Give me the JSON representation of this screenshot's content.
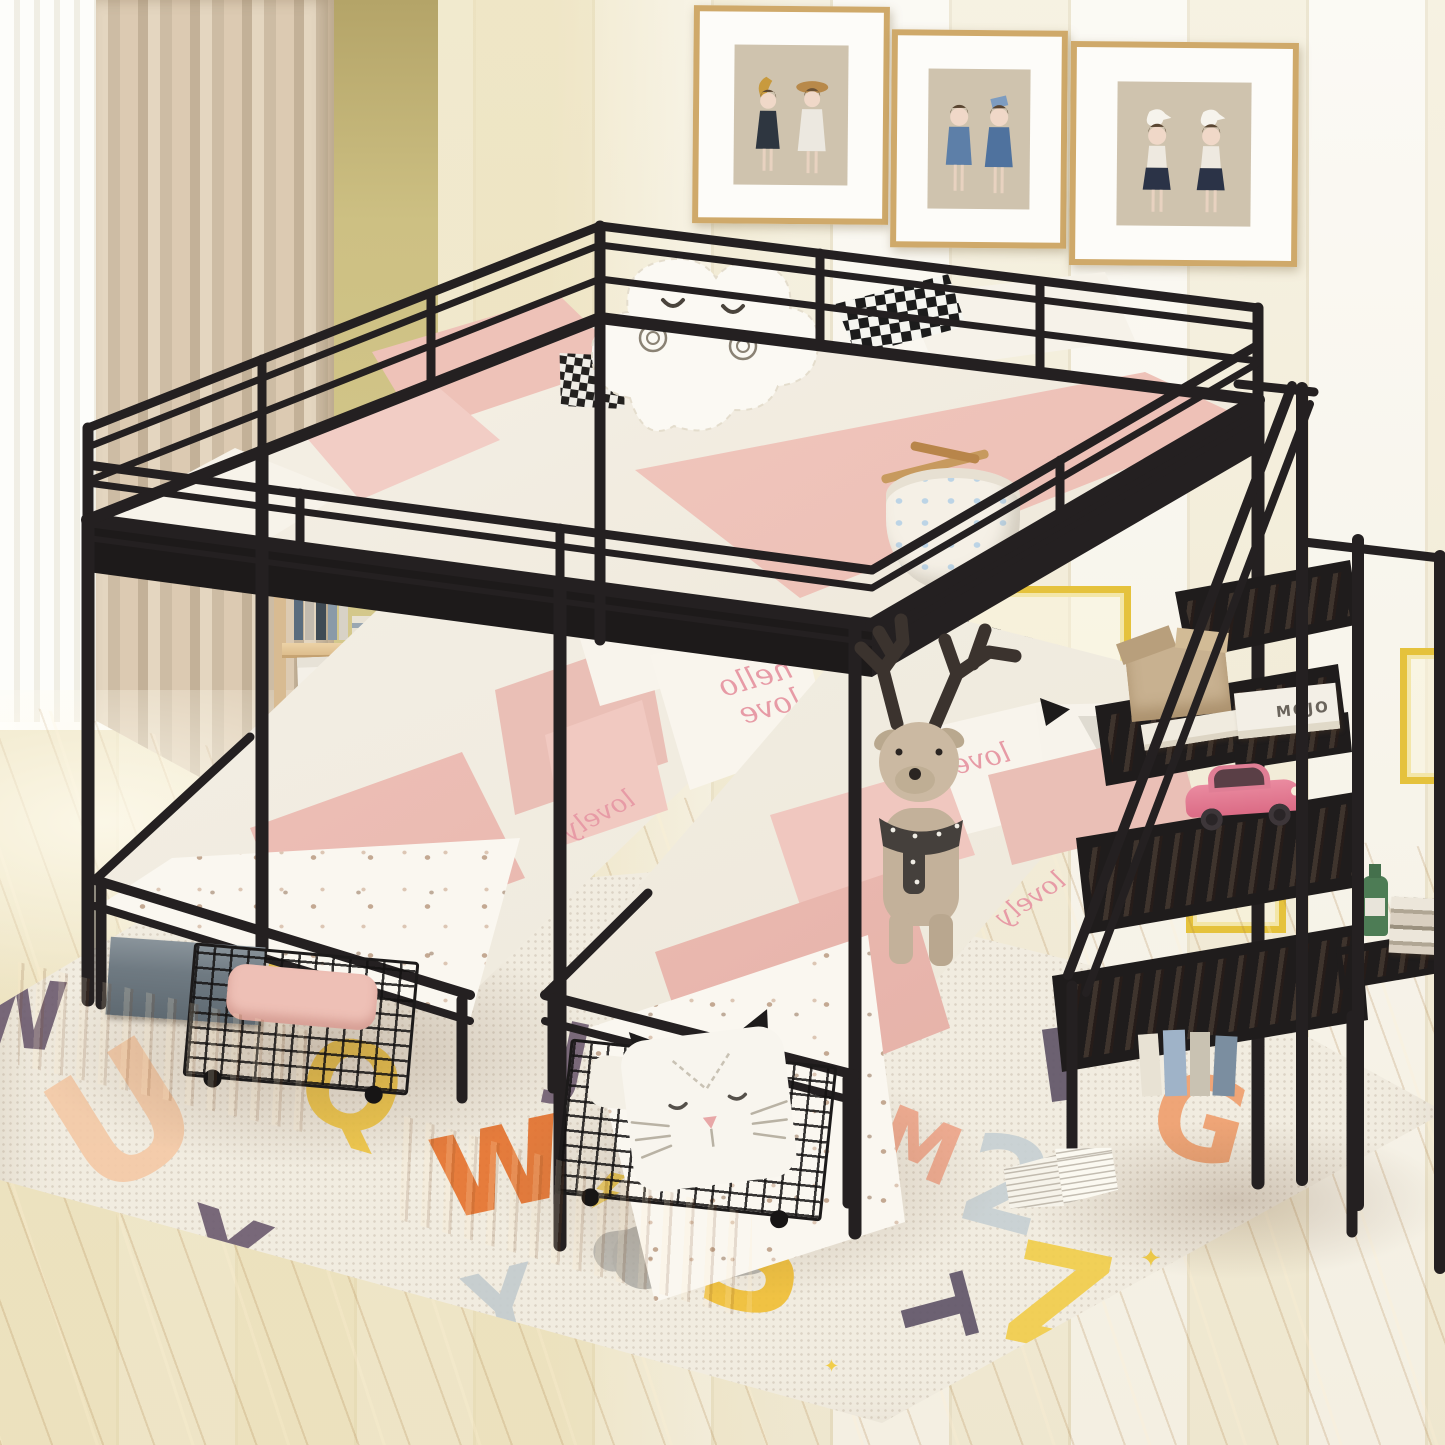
{
  "scene": {
    "description": "Kids bedroom product photo: black metal full-over-twin-twin triple bunk bed with storage staircase, pink and white bedding, alphabet rug, wall art prints",
    "wall_art": {
      "frames": [
        {
          "name": "print-girls-with-moon-and-hat"
        },
        {
          "name": "print-girls-in-blue-with-book"
        },
        {
          "name": "print-girls-with-geese"
        }
      ]
    },
    "counts": {
      "picture_frames": 3,
      "stair_steps": 4,
      "under_bed_drawers": 2,
      "twin_beds": 2
    }
  },
  "palette": {
    "metal_frame": "#242021",
    "wall_cream": "#f3edd8",
    "wall_white": "#faf8f1",
    "wall_olive": "#cdc083",
    "curtain_beige": "#d9c9b1",
    "floor_wood": "#e2c69c",
    "rug_cream": "#f1ece0",
    "bedding_pink": "#efc5bc",
    "bedding_white": "#f6f2e9",
    "step_wood": "#984b28",
    "drawer_wood": "#c08049",
    "shelf_wood": "#e5c99e",
    "gold_molding": "#e5c23c",
    "toy_car_pink": "#e0728a"
  },
  "texts": {
    "pillow_script_1": "hello love",
    "pillow_script_2": "love",
    "duvet_script": "lovely",
    "book_spine": "MOJO"
  },
  "rug": {
    "letters": [
      {
        "char": "U",
        "color": "#f4c9a6",
        "x": 55,
        "y": 1035,
        "size": 170,
        "rot": -32
      },
      {
        "char": "Q",
        "color": "#f1c741",
        "x": 300,
        "y": 1028,
        "size": 120,
        "rot": 16
      },
      {
        "char": "B",
        "color": "#f1c741",
        "x": 262,
        "y": 922,
        "size": 82,
        "rot": 10
      },
      {
        "char": "J",
        "color": "#6f5d72",
        "x": 556,
        "y": 1012,
        "size": 92,
        "rot": 12
      },
      {
        "char": "w",
        "color": "#e5702b",
        "x": 428,
        "y": 1082,
        "size": 150,
        "rot": -12
      },
      {
        "char": "X",
        "color": "#6b5a6e",
        "x": 178,
        "y": 1200,
        "size": 115,
        "rot": 18
      },
      {
        "char": "Y",
        "color": "#c3cbce",
        "x": 468,
        "y": 1258,
        "size": 96,
        "rot": -14
      },
      {
        "char": "S",
        "color": "#f0be33",
        "x": 698,
        "y": 1182,
        "size": 152,
        "rot": 8
      },
      {
        "char": "Z",
        "color": "#f1cd49",
        "x": 1008,
        "y": 1232,
        "size": 140,
        "rot": 12
      },
      {
        "char": "T",
        "color": "#5e5366",
        "x": 903,
        "y": 1262,
        "size": 96,
        "rot": 75
      },
      {
        "char": "2",
        "color": "#c6d0d3",
        "x": 962,
        "y": 1122,
        "size": 126,
        "rot": 15
      },
      {
        "char": "M",
        "color": "#efa68a",
        "x": 878,
        "y": 1106,
        "size": 82,
        "rot": 22
      },
      {
        "char": "G",
        "color": "#ef9e6c",
        "x": 1152,
        "y": 1062,
        "size": 116,
        "rot": 15
      },
      {
        "char": "F",
        "color": "#5e5366",
        "x": 1038,
        "y": 1015,
        "size": 100,
        "rot": -8
      },
      {
        "char": "Z",
        "color": "#6b5a6e",
        "x": -2,
        "y": 1230,
        "size": 86,
        "rot": 28
      },
      {
        "char": "W",
        "color": "#6b5a6e",
        "x": -38,
        "y": 968,
        "size": 95,
        "rot": 5
      }
    ],
    "sparkles": [
      {
        "glyph": "✦",
        "color": "#f1cd49",
        "x": 1140,
        "y": 1246,
        "size": 26
      },
      {
        "glyph": "✦",
        "color": "#f1cd49",
        "x": 824,
        "y": 1358,
        "size": 18
      },
      {
        "glyph": "✦",
        "color": "#efa68a",
        "x": 876,
        "y": 1182,
        "size": 14
      },
      {
        "glyph": "~",
        "color": "#9a958c",
        "x": 845,
        "y": 1112,
        "size": 24
      }
    ]
  }
}
